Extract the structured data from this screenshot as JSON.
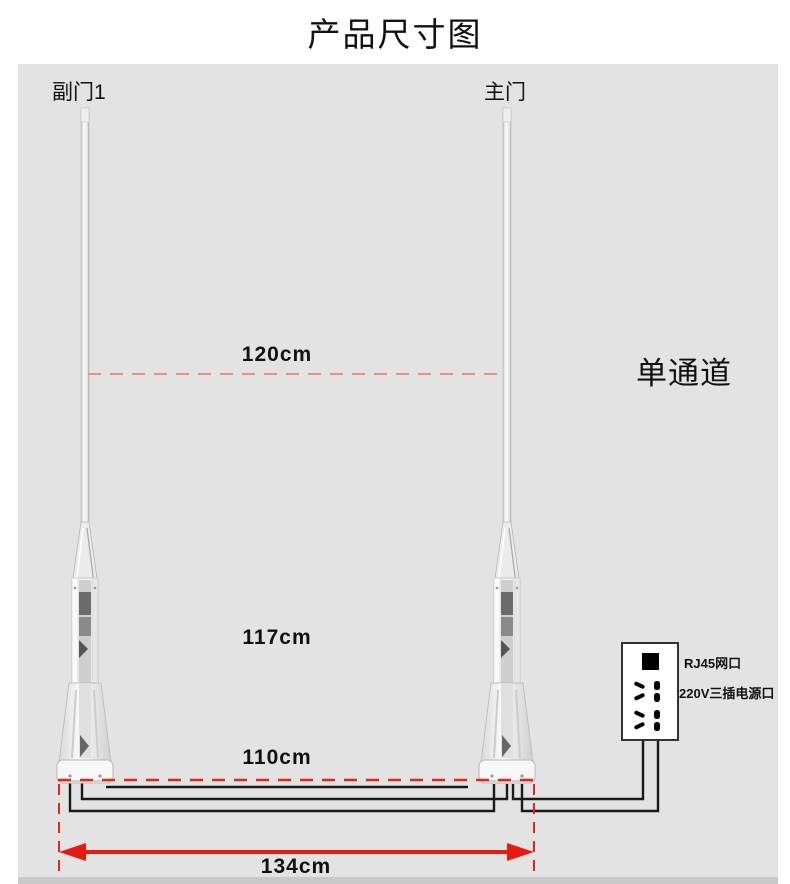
{
  "page": {
    "title": "产品尺寸图"
  },
  "diagram": {
    "left_pole_label": "副门1",
    "right_pole_label": "主门",
    "channel_label": "单通道",
    "dimensions": {
      "top_width": "120cm",
      "mid_width": "117cm",
      "base_width": "110cm",
      "overall_width": "134cm"
    },
    "socket": {
      "rj45_label": "RJ45网口",
      "power_label": "220V三插电源口"
    },
    "colors": {
      "panel_bg": "#e3e3e3",
      "dimension_red": "#e02818",
      "soft_red": "#e78f8f",
      "arrow_red": "#e81a10",
      "wire_black": "#1a1a1a"
    }
  }
}
